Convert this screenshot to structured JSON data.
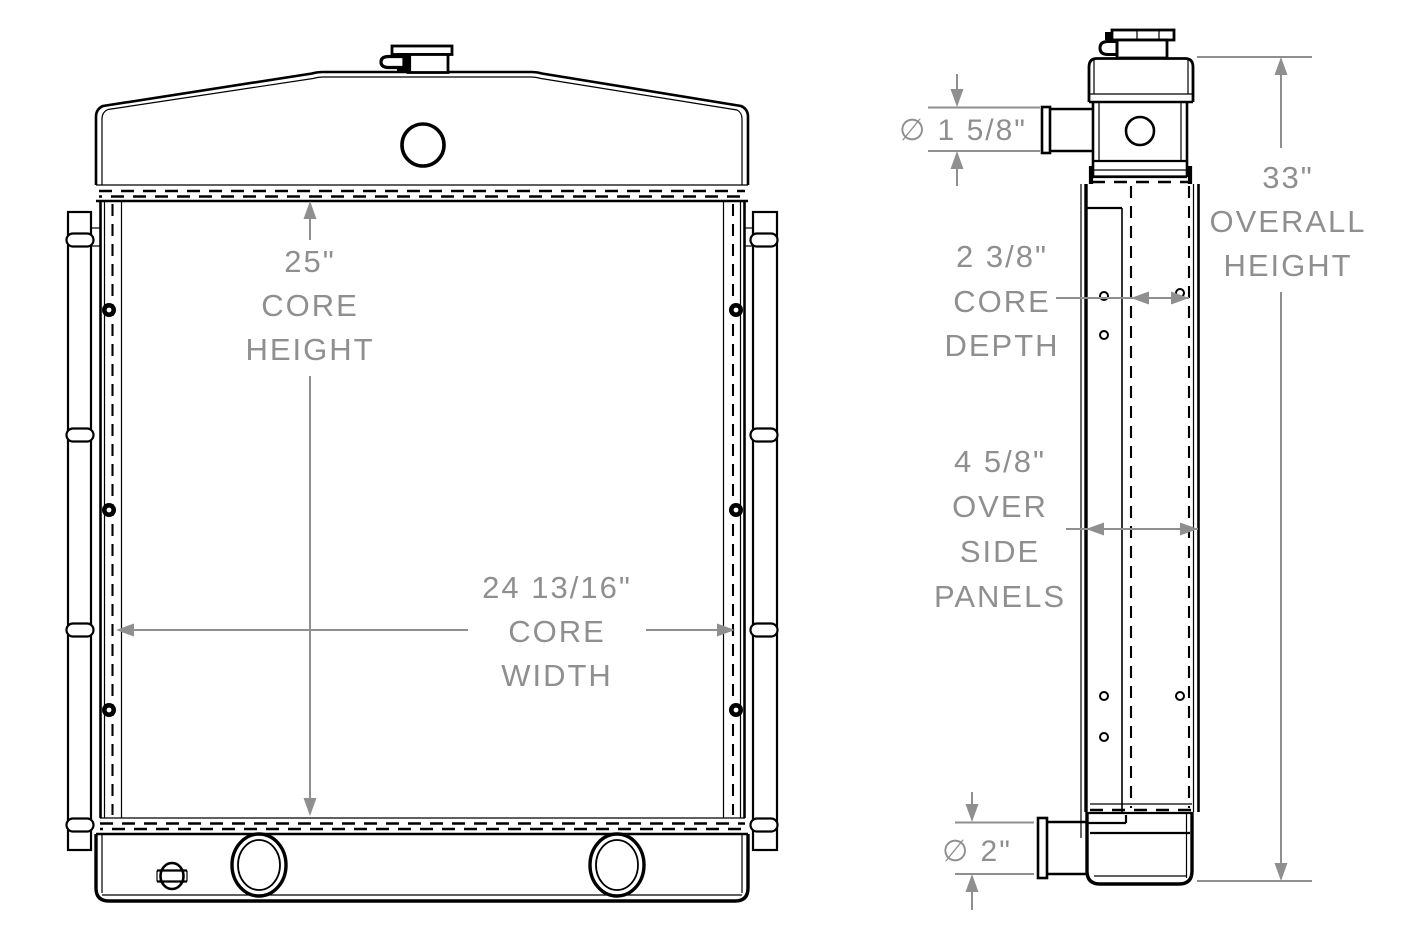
{
  "colors": {
    "line": "#000000",
    "dimension_gray": "#8f8f8f",
    "background": "#ffffff"
  },
  "front_view": {
    "core_height": {
      "value": "25\"",
      "label_line1": "CORE",
      "label_line2": "HEIGHT"
    },
    "core_width": {
      "value": "24 13/16\"",
      "label_line1": "CORE",
      "label_line2": "WIDTH"
    }
  },
  "side_view": {
    "inlet_diameter": {
      "value": "∅ 1 5/8\""
    },
    "core_depth": {
      "value": "2 3/8\"",
      "label_line1": "CORE",
      "label_line2": "DEPTH"
    },
    "over_side_panels": {
      "value": "4 5/8\"",
      "label_line1": "OVER",
      "label_line2": "SIDE",
      "label_line3": "PANELS"
    },
    "overall_height": {
      "value": "33\"",
      "label_line1": "OVERALL",
      "label_line2": "HEIGHT"
    },
    "outlet_diameter": {
      "value": "∅ 2\""
    }
  }
}
